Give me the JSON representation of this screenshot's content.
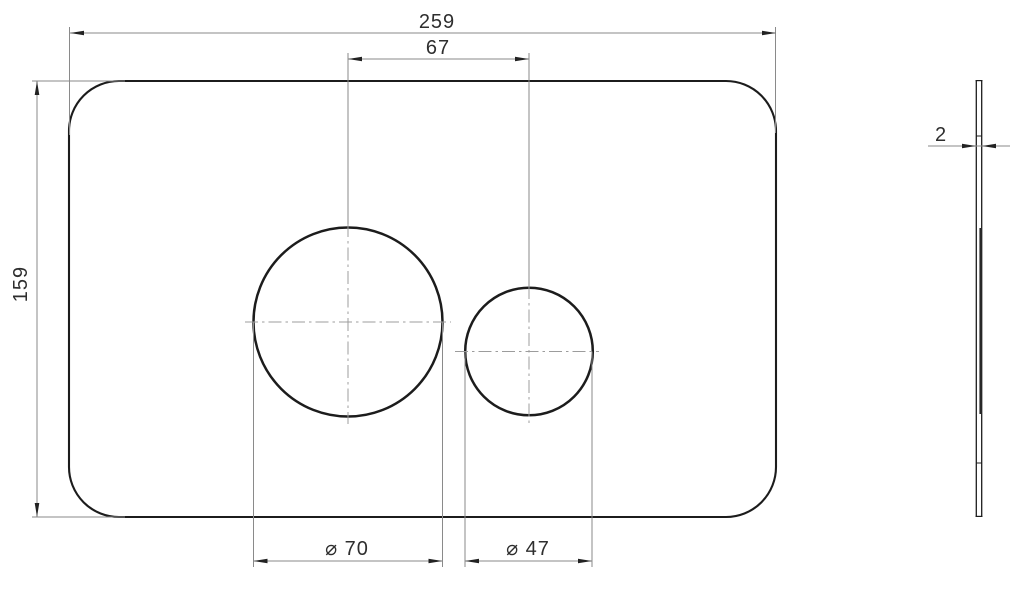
{
  "dimensions": {
    "overall_width": "259",
    "button_spacing": "67",
    "overall_height": "159",
    "large_button_diameter": "⌀ 70",
    "small_button_diameter": "⌀ 47",
    "thickness": "2"
  },
  "colors": {
    "background": "#ffffff",
    "outline": "#1c1c1c",
    "dimension_lines": "#8a8a8a",
    "centerlines": "#9c9c9c",
    "text": "#2e2e2e"
  }
}
